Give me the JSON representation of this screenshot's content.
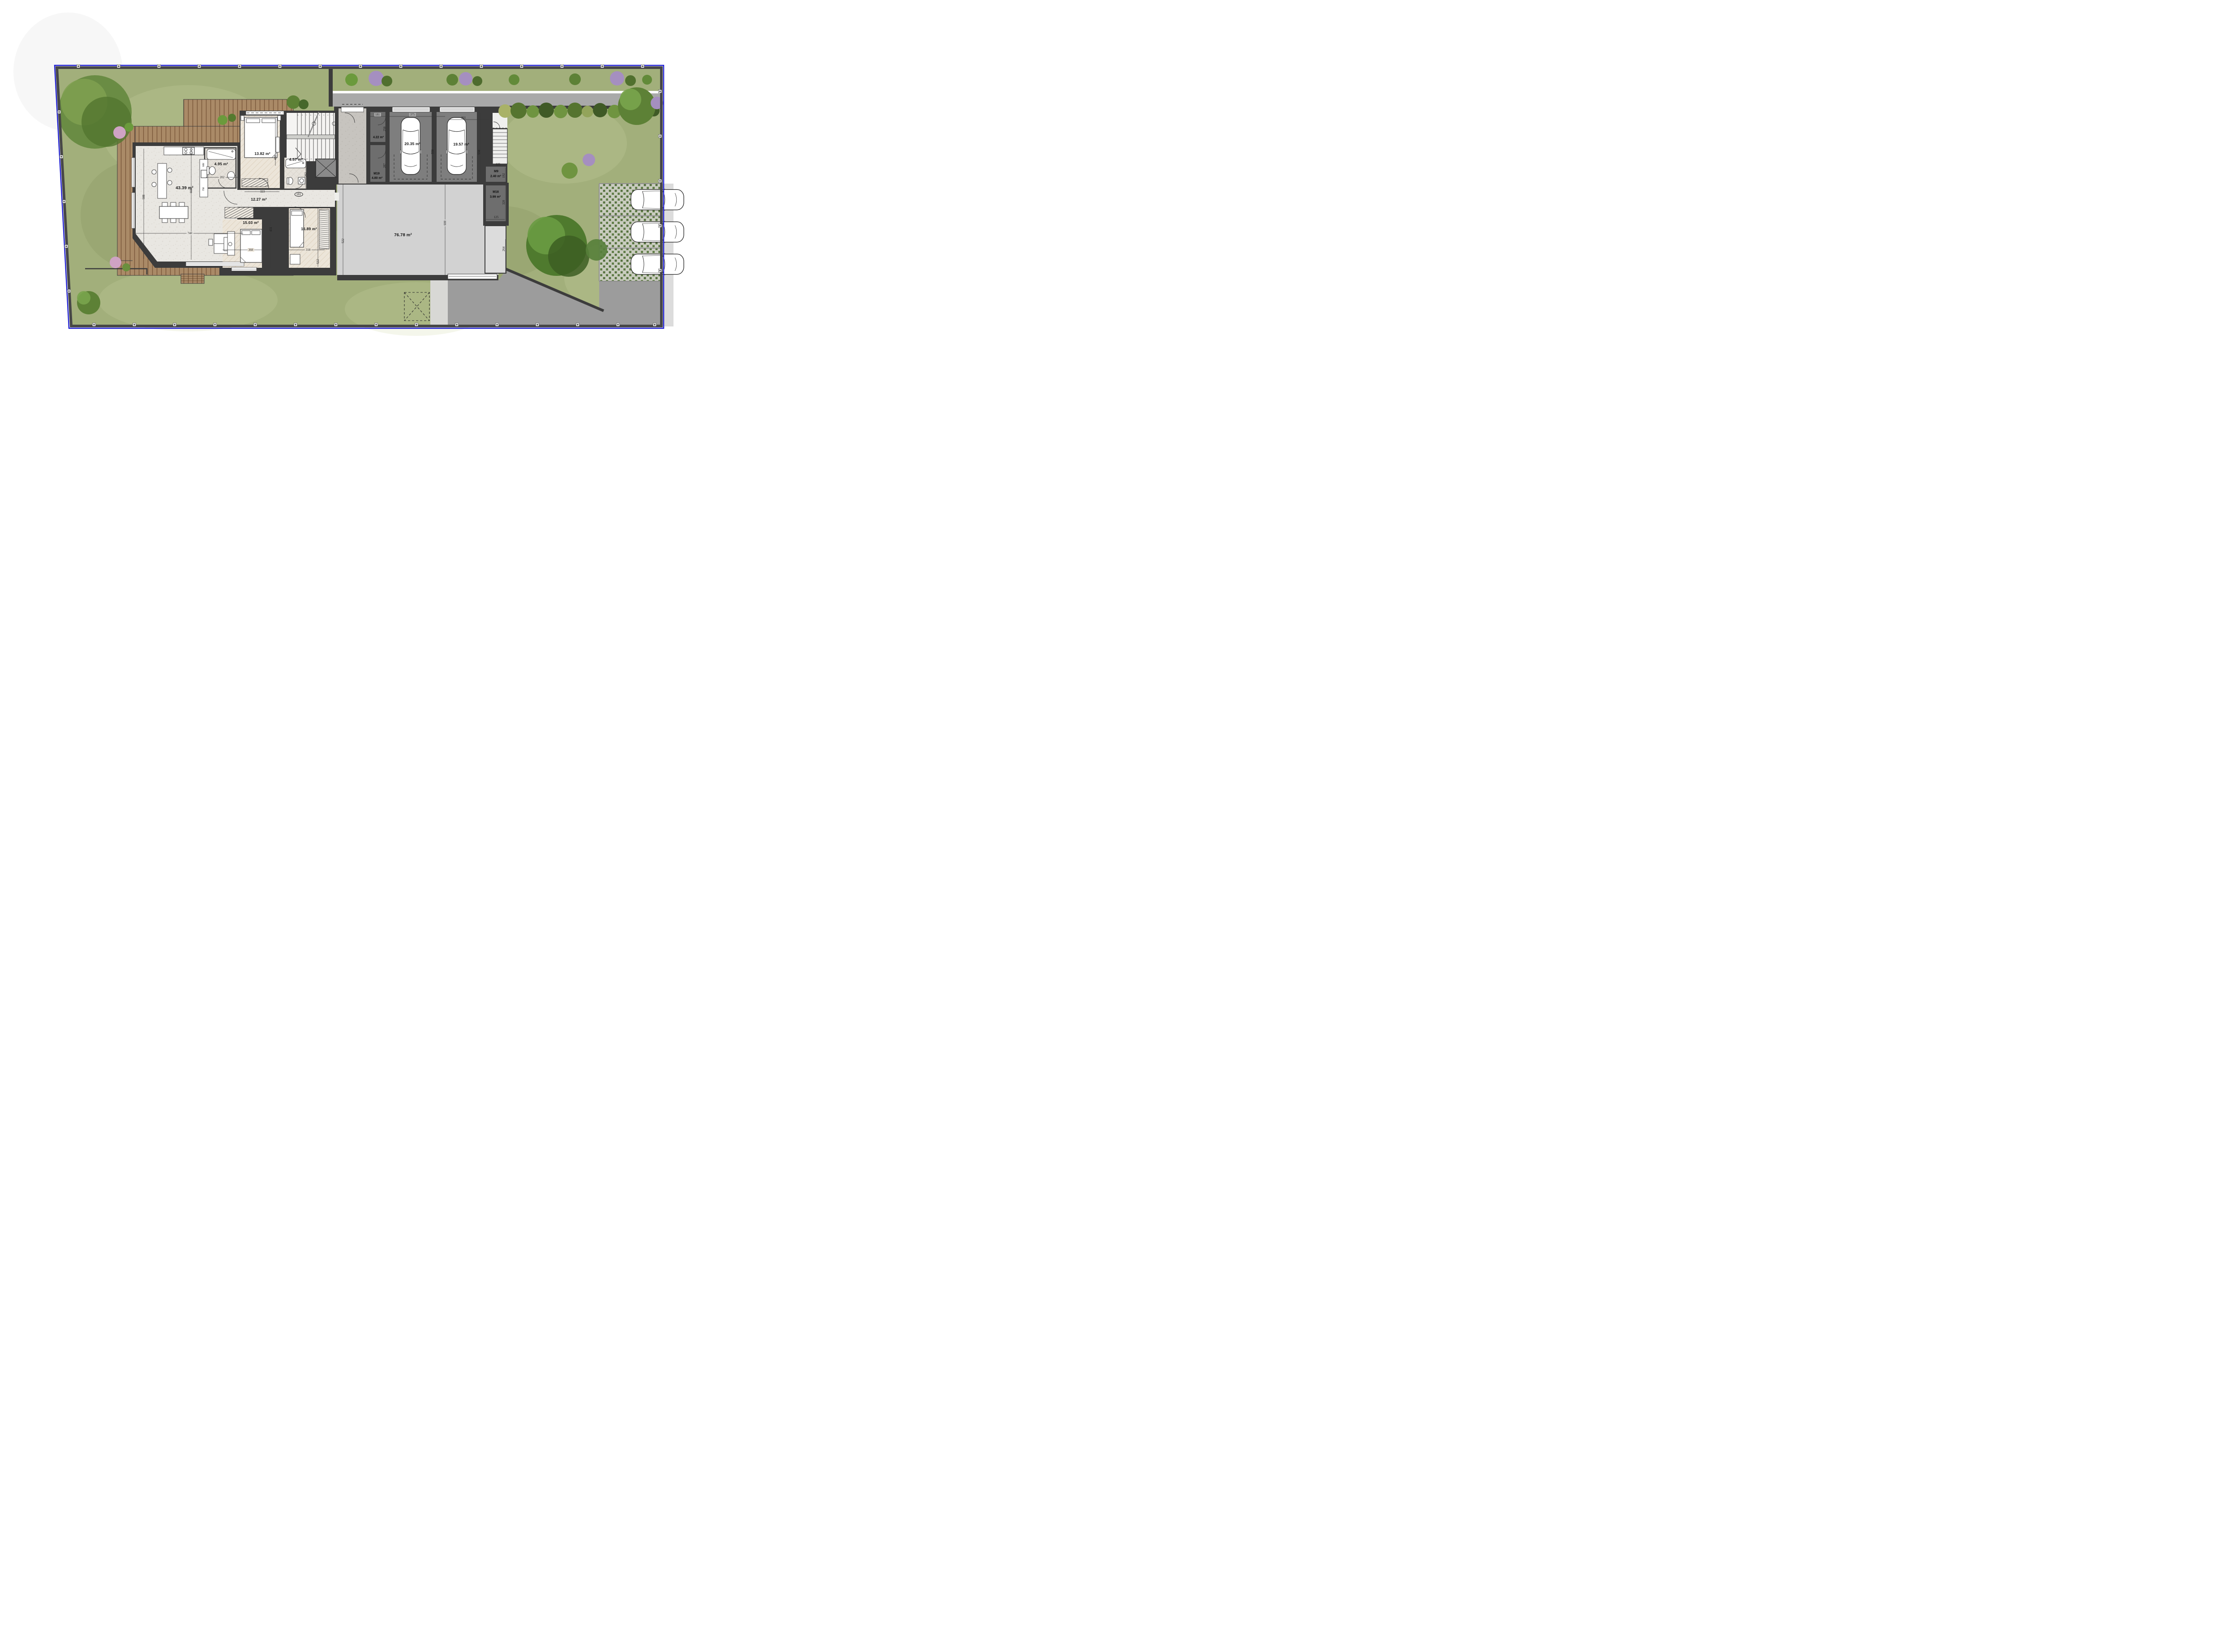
{
  "site": {
    "rooms": {
      "living": "43.39 m²",
      "hall": "12.27 m²",
      "bedroom1": "13.82 m²",
      "bath1": "4.95 m²",
      "bath2": "4.57 m²",
      "bedroom2": "15.03 m²",
      "bedroom3": "16.89 m²",
      "storage": "4.22 m²",
      "garage1": "20.35 m²",
      "garage2": "19.57 m²",
      "courtyard": "76.78 m²",
      "m19": "M19",
      "m19_area": "4.80 m²",
      "m9": "M9",
      "m9_area": "2.40 m²",
      "m18": "M18",
      "m18_area": "3.99 m²"
    },
    "dims": {
      "d588": "588",
      "d660": "660",
      "d740": "740",
      "d202": "202",
      "d428": "428",
      "d323": "323",
      "d262": "262",
      "d181_door": "181",
      "d360": "360",
      "d431": "431",
      "d318": "318",
      "d522a": "522",
      "d522b": "522",
      "d600": "600",
      "d181_top": "181",
      "d375": "375",
      "d361": "361",
      "d250": "250",
      "d287": "287",
      "d550a": "550",
      "d550b": "550",
      "d125a": "125",
      "d192": "192",
      "d320": "320",
      "d125b": "125",
      "d264": "264"
    },
    "appliances": {
      "mm": "MM",
      "pm": "ПМ"
    },
    "stair_steps": [
      "1",
      "2",
      "3",
      "4",
      "5",
      "6",
      "7",
      "8",
      "9",
      "10",
      "11",
      "12",
      "13",
      "14",
      "15",
      "16",
      "17",
      "18"
    ]
  }
}
